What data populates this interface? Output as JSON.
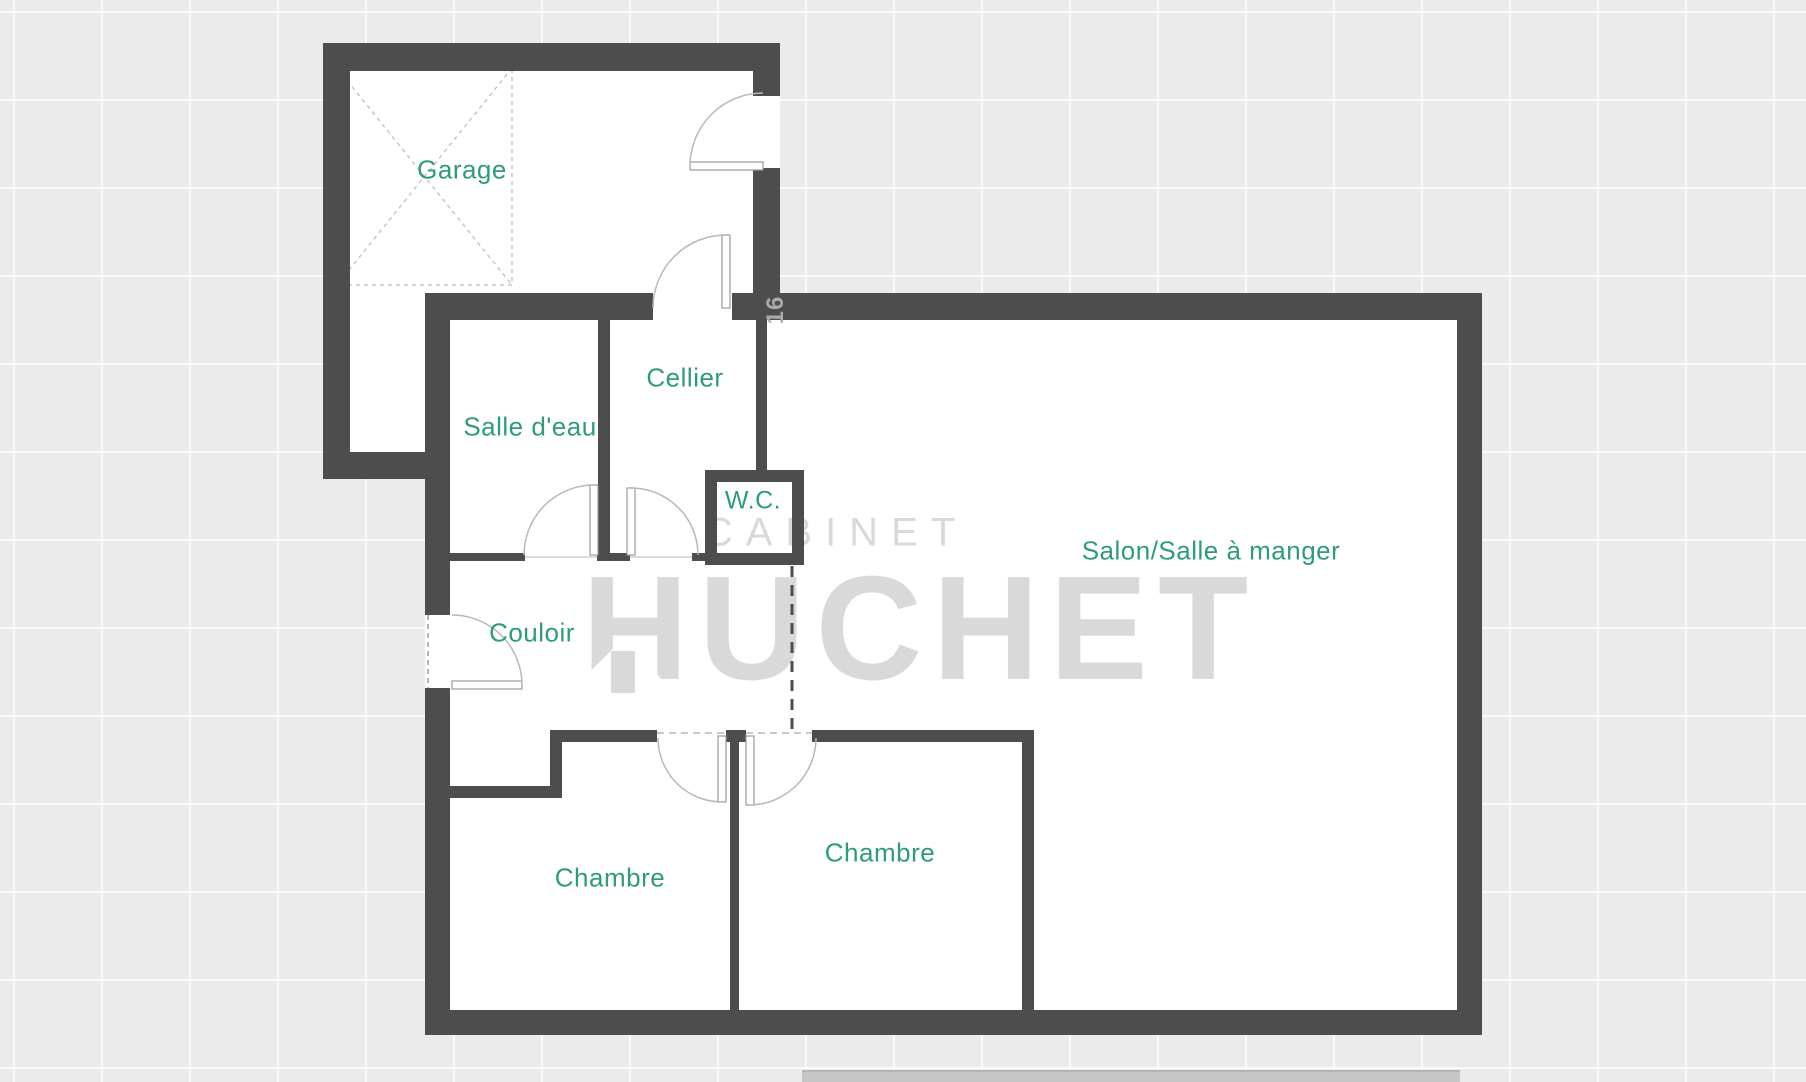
{
  "plan": {
    "rooms": [
      {
        "id": "garage",
        "label": "Garage"
      },
      {
        "id": "salle-deau",
        "label": "Salle d'eau"
      },
      {
        "id": "cellier",
        "label": "Cellier"
      },
      {
        "id": "wc",
        "label": "W.C."
      },
      {
        "id": "couloir",
        "label": "Couloir"
      },
      {
        "id": "salon",
        "label": "Salon/Salle à manger"
      },
      {
        "id": "chambre-1",
        "label": "Chambre"
      },
      {
        "id": "chambre-2",
        "label": "Chambre"
      }
    ],
    "dimension_label": "16"
  },
  "watermark": {
    "line1": "CABINET",
    "line2": "HUCHET"
  },
  "colors": {
    "wall": "#4d4d4d",
    "room_label": "#2f9b7d",
    "watermark": "#d9d9d9",
    "background": "#ebebeb",
    "door_leaf_stroke": "#999999",
    "door_arc": "#b8b8b8",
    "parking_dash": "#c6c6c6",
    "dimension_label": "#aaaaaa"
  }
}
